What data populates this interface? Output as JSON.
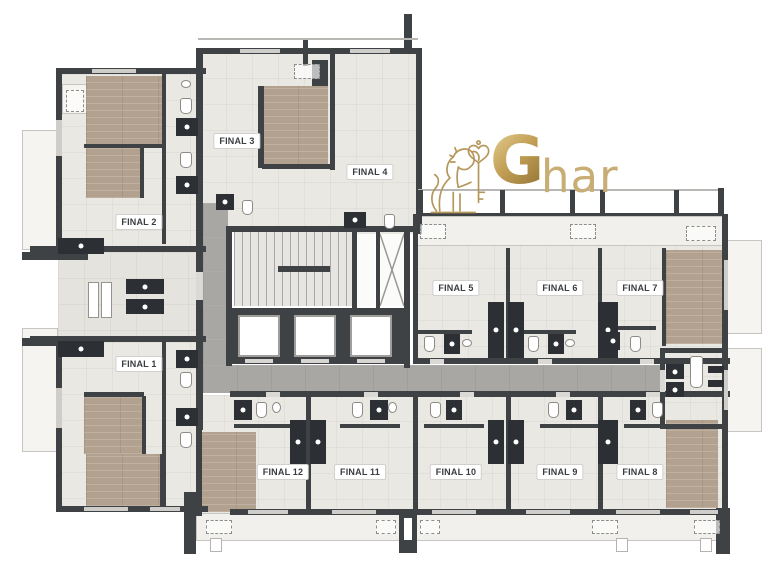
{
  "meta": {
    "type": "architectural-floor-plan",
    "background": "#ffffff"
  },
  "logo": {
    "icon": "lion-with-key-icon",
    "brand_initial": "G",
    "brand_rest": "har",
    "colors": {
      "gold": "#b5975c",
      "gold_light": "#e6d095",
      "gold_dark": "#8e6e32"
    }
  },
  "palette": {
    "wall": "#3f4245",
    "floor": "#eae8e3",
    "wood_floor": "#b2a18e",
    "corridor": "#a9a7a4",
    "balcony": "#f5f4f1",
    "fixture_dark": "#2c2f33",
    "fixture_white": "#ffffff"
  },
  "units": [
    {
      "id": "final-1",
      "label": "FINAL 1"
    },
    {
      "id": "final-2",
      "label": "FINAL 2"
    },
    {
      "id": "final-3",
      "label": "FINAL 3"
    },
    {
      "id": "final-4",
      "label": "FINAL 4"
    },
    {
      "id": "final-5",
      "label": "FINAL 5"
    },
    {
      "id": "final-6",
      "label": "FINAL 6"
    },
    {
      "id": "final-7",
      "label": "FINAL 7"
    },
    {
      "id": "final-8",
      "label": "FINAL 8"
    },
    {
      "id": "final-9",
      "label": "FINAL 9"
    },
    {
      "id": "final-10",
      "label": "FINAL 10"
    },
    {
      "id": "final-11",
      "label": "FINAL 11"
    },
    {
      "id": "final-12",
      "label": "FINAL 12"
    }
  ],
  "core": {
    "elevator_count": 3,
    "has_staircase": true
  }
}
